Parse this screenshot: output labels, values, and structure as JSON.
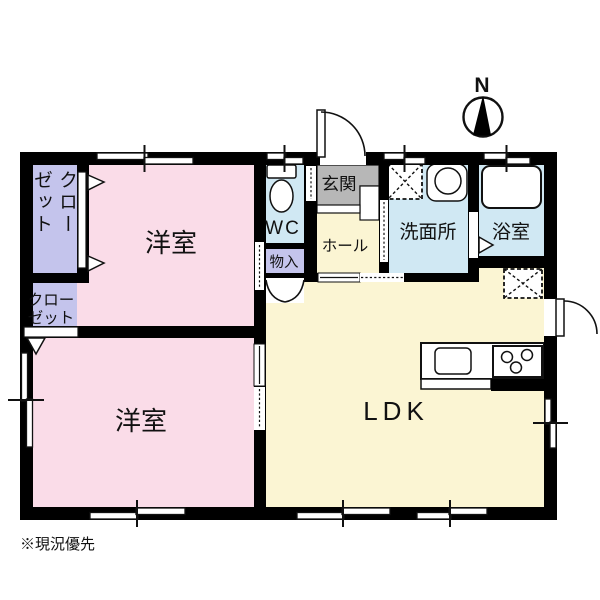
{
  "floorplan": {
    "note": "※現況優先",
    "compass": {
      "label": "N"
    },
    "rooms": {
      "bedroom_top": {
        "label": "洋室"
      },
      "bedroom_bottom": {
        "label": "洋室"
      },
      "ldk": {
        "label": "LDK"
      },
      "wc": {
        "label": "WC"
      },
      "entrance": {
        "label": "玄関"
      },
      "hall": {
        "label": "ホール"
      },
      "storage": {
        "label": "物入"
      },
      "washroom": {
        "label": "洗面所"
      },
      "bathroom": {
        "label": "浴室"
      },
      "closet_upper": {
        "label": "クローゼット"
      },
      "closet_lower": {
        "line1": "クロー",
        "line2": "ゼット"
      }
    },
    "icons": [
      "toilet-icon",
      "bathtub-icon",
      "washbasin-icon",
      "washing-machine-space-icon",
      "refrigerator-space-icon",
      "kitchen-sink-icon",
      "stove-icon",
      "compass-icon",
      "entrance-door-arc",
      "back-door-arc",
      "double-closet-door-arcs"
    ],
    "colors": {
      "wall": "#000000",
      "bedroom": "#fadce8",
      "ldk": "#fbf5d3",
      "wet_area": "#d0e8f3",
      "closet": "#c4c4ec",
      "entrance_floor": "#b7b7b7",
      "background": "#ffffff"
    }
  }
}
